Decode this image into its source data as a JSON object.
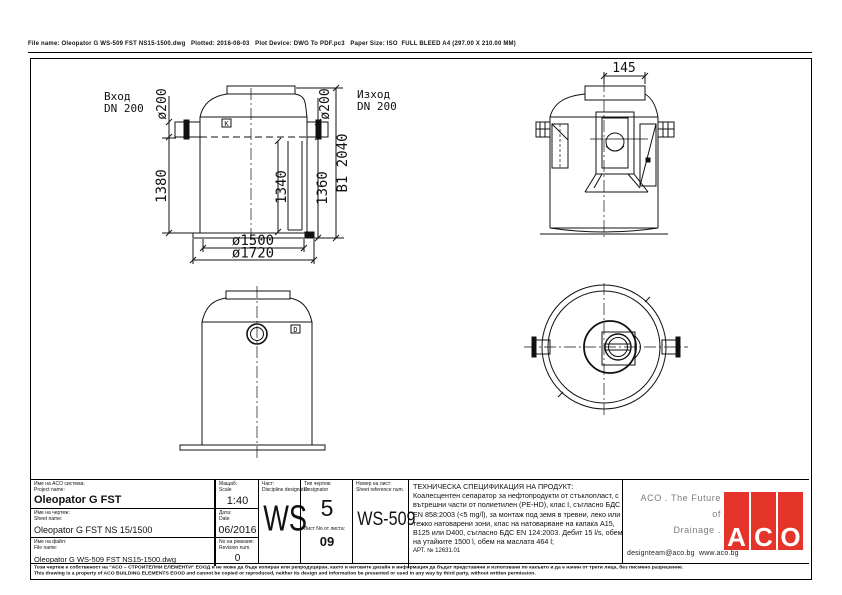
{
  "page": {
    "header_line": "File name: Oleopator G WS-509 FST NS15-1500.dwg   Plotted: 2016-08-03   Plot Device: DWG To PDF.pc3   Paper Size: ISO  FULL BLEED A4 (297.00 X 210.00 MM)"
  },
  "drawing": {
    "section_view": {
      "inlet_label": {
        "line1": "Вход",
        "line2": "DN 200"
      },
      "outlet_label": {
        "line1": "Изход",
        "line2": "DN 200"
      },
      "dims": {
        "inlet_dia": "ø200",
        "outlet_dia": "ø200",
        "left_height": "1380",
        "inner_height": "1340",
        "right_height": "1360",
        "overall_height": "B1 2040",
        "inner_dia": "ø1500",
        "outer_dia": "ø1720"
      },
      "marker": "K"
    },
    "side_view": {
      "dims": {
        "cover_offset": "145"
      }
    },
    "front_view": {
      "marker": "D"
    }
  },
  "title_block": {
    "project": {
      "label_bg": "Име на ACO система:",
      "label_en": "Project name:",
      "value": "Oleopator G FST"
    },
    "sheet": {
      "label_bg": "Име на чертеж:",
      "label_en": "Sheet name:",
      "value": "Oleopator G FST NS 15/1500"
    },
    "file": {
      "label_bg": "Име на файл:",
      "label_en": "File name:",
      "value": "Oleopator G WS-509 FST NS15-1500.dwg"
    },
    "scale": {
      "label_bg": "Мащаб:",
      "label_en": "Scale",
      "value": "1:40"
    },
    "date": {
      "label_bg": "Дата:",
      "label_en": "Date",
      "value": "06/2016"
    },
    "revision": {
      "label_bg": "Nо на ревизия:",
      "label_en": "Revision num.",
      "value": "0"
    },
    "discipline": {
      "label_bg": "Част:",
      "label_en": "Discipline designator",
      "value": "WS"
    },
    "designator": {
      "label_bg": "Тип чертеж:",
      "label_en": "Designator",
      "value": "5"
    },
    "sheet_no": {
      "label": "Лист No от листа:",
      "value": "09"
    },
    "sheet_ref": {
      "label_bg": "Номер на лист:",
      "label_en": "Sheet reference num.",
      "value": "WS-509"
    },
    "spec": {
      "title": "ТЕХНИЧЕСКА СПЕЦИФИКАЦИЯ НА ПРОДУКТ:",
      "body": "Коалесцентен сепаратор за нефтопродукти от стъклопласт, с вътрешни части от полиетилен (PE-HD), клас I, съгласно БДС EN 858:2003 (<5 mg/l), за монтаж под земя в тревни, леко или тежко натоварени зони, клас на натоварване на капака A15, B125 или D400, съгласно БДС EN 124:2003. Дебит 15 l/s, обем на утайките 1500 l, обем на маслата 464 l;",
      "art_no": "АРТ. № 12631.01"
    }
  },
  "branding": {
    "tagline_line1": "ACO . The Future of",
    "tagline_line2": "Drainage .",
    "contact": "designteam@aco.bg  www.aco.bg",
    "logo_letters": [
      "A",
      "C",
      "O"
    ],
    "brand_red": "#e5352b",
    "tagline_gray": "#7d7d7d"
  },
  "disclaimer": {
    "line1": "Този чертеж е собственост на \"АСО – СТРОИТЕЛНИ ЕЛЕМЕНТИ\" ЕООД и не може да бъде копиран или репродуциран, както и неговите дизайн и информация да бъдат представяни и използвани по какъвто и да е начин от трети лица, без писмено разрешение.",
    "line2": "This drawing is a property of ACO BUILDING ELEMENTS EOOD and cannot be copied or reproduced, neither its design and information be presented or used in any way by third party, without written permission."
  }
}
